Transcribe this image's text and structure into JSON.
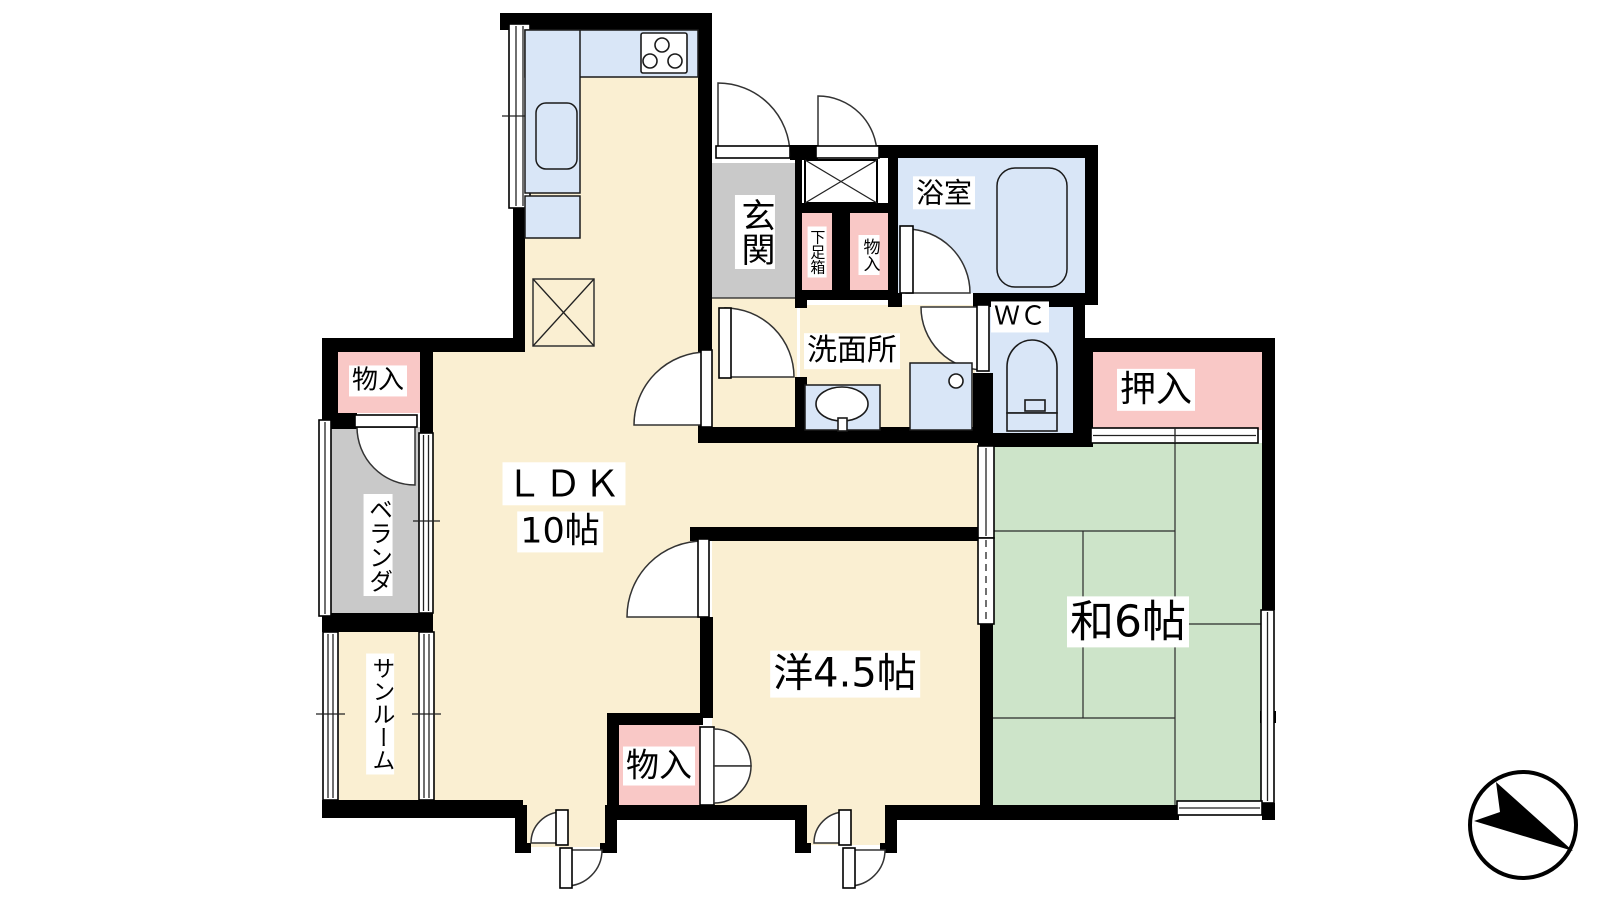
{
  "title": "apartment-floor-plan",
  "colors": {
    "room_cream": "#FAEFD2",
    "water_blue": "#D9E6F7",
    "tatami_green": "#CDE4C9",
    "storage_pink": "#F9C8C6",
    "entry_gray": "#C9C9C9",
    "wall_black": "#000000"
  },
  "rooms": {
    "ldk": {
      "label": "ＬＤＫ",
      "size": "10帖"
    },
    "western": {
      "label": "洋4.5帖"
    },
    "japanese": {
      "label": "和6帖"
    },
    "oshiire": {
      "label": "押入"
    },
    "genkan": {
      "label": "玄関"
    },
    "shoe_box": {
      "label": "下足箱"
    },
    "storage_entry": {
      "label": "物入"
    },
    "bath": {
      "label": "浴室"
    },
    "washroom": {
      "label": "洗面所"
    },
    "wc": {
      "label": "ＷＣ"
    },
    "veranda": {
      "label": "ベランダ"
    },
    "sunroom": {
      "label": "サンルーム"
    },
    "storage_west": {
      "label": "物入"
    },
    "storage_bottom": {
      "label": "物入"
    }
  }
}
